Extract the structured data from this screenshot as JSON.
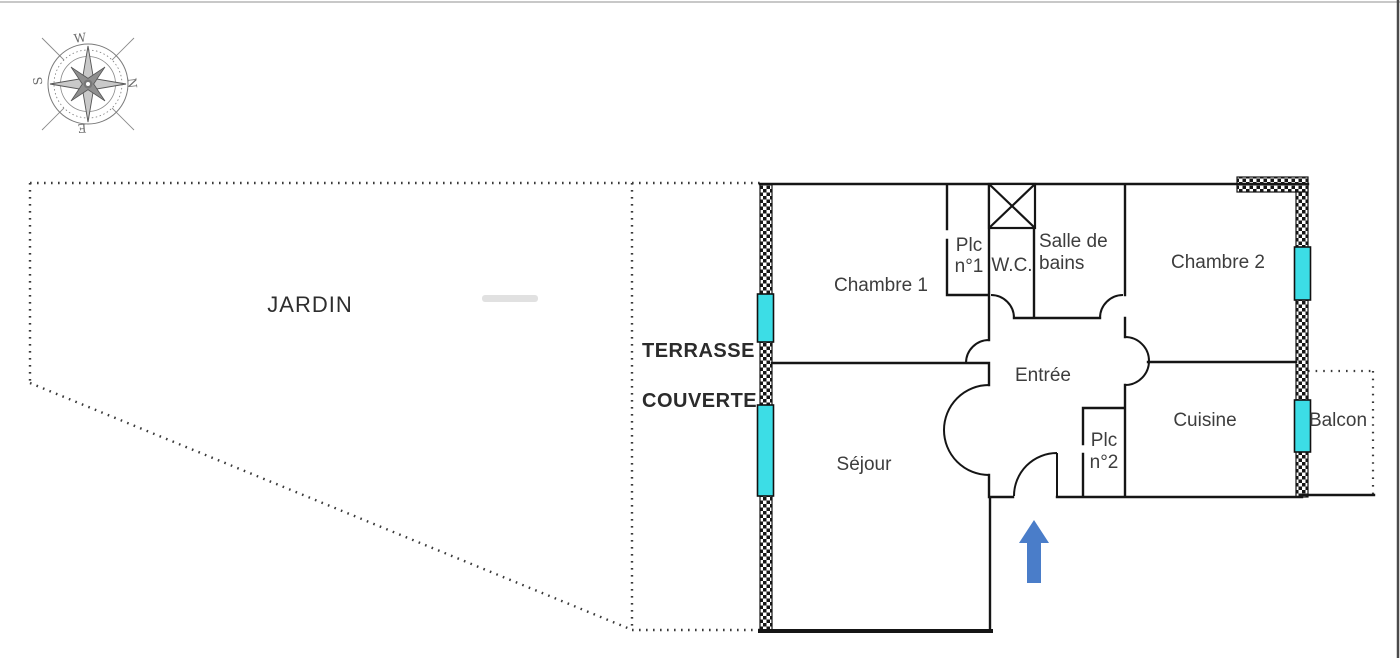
{
  "outdoor": {
    "garden": "JARDIN",
    "terrace_line1": "TERRASSE",
    "terrace_line2": "COUVERTE",
    "balcony": "Balcon"
  },
  "rooms": {
    "bedroom1": "Chambre 1",
    "bedroom2": "Chambre 2",
    "living_room": "Séjour",
    "kitchen": "Cuisine",
    "entry": "Entrée",
    "bathroom_line1": "Salle de",
    "bathroom_line2": "bains",
    "wc": "W.C.",
    "closet1_line1": "Plc",
    "closet1_line2": "n°1",
    "closet2_line1": "Plc",
    "closet2_line2": "n°2"
  },
  "compass": {
    "top": "W",
    "right": "N",
    "bottom": "E",
    "left": "S"
  },
  "colors": {
    "wall": "#151515",
    "window_glass": "#3cdde6",
    "entrance_arrow": "#4a7dc9",
    "label_text": "#3d3d3d"
  }
}
